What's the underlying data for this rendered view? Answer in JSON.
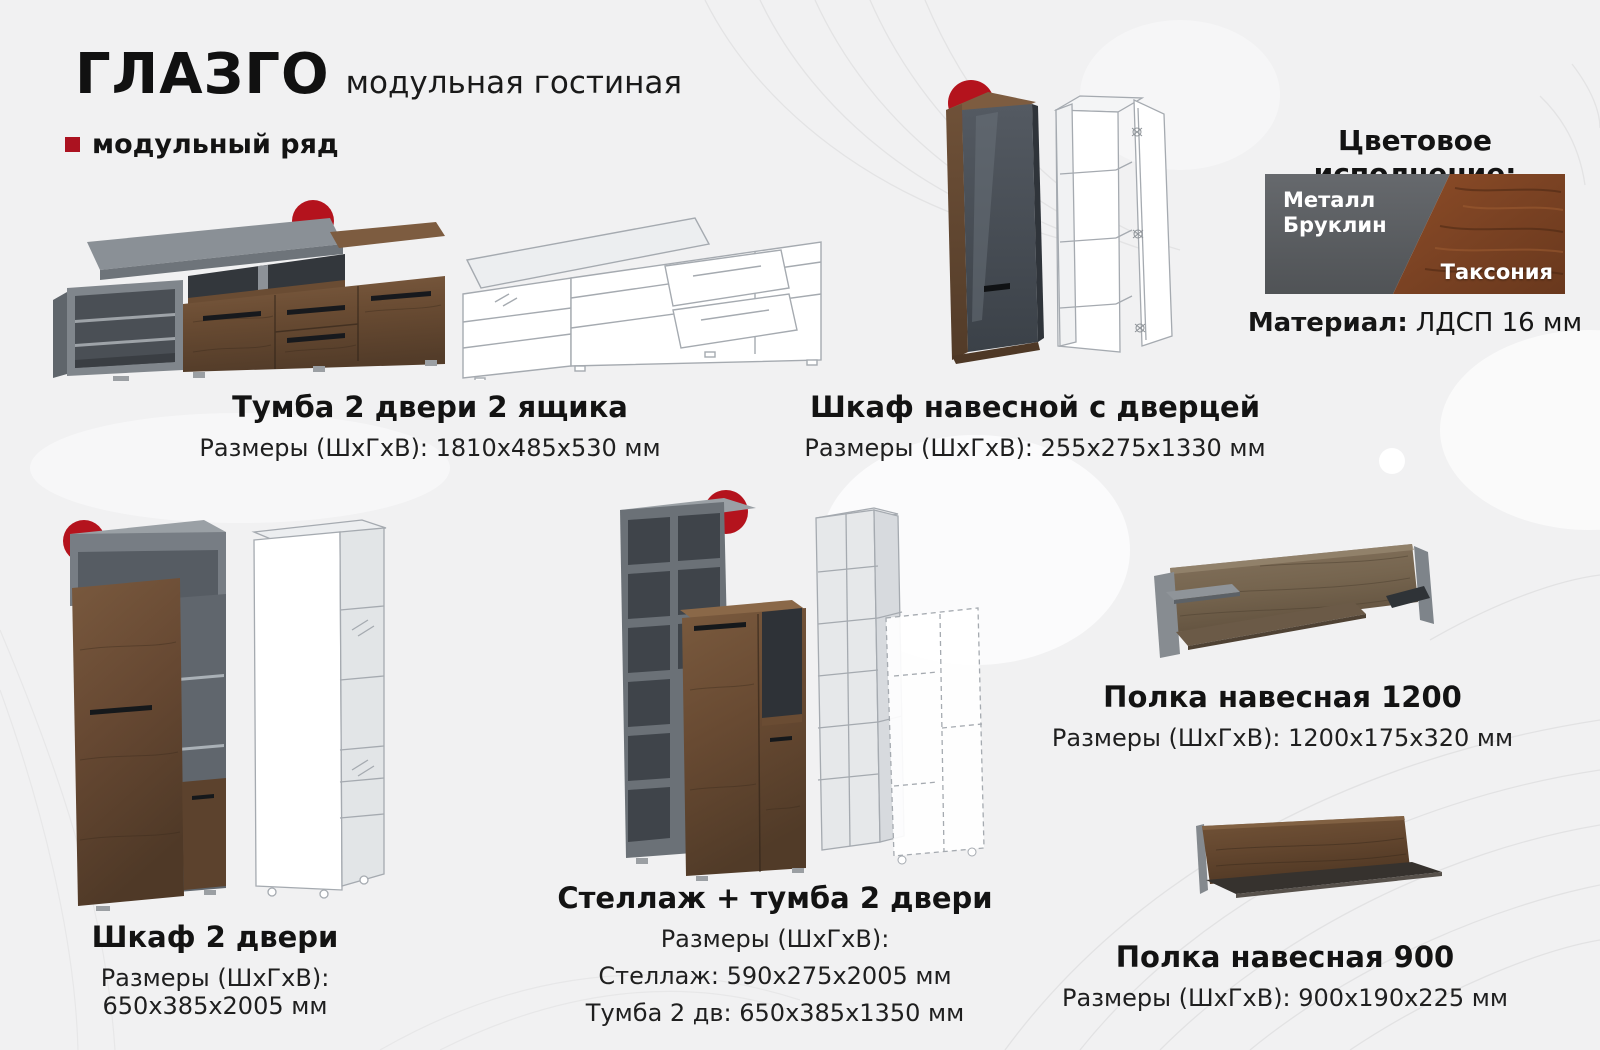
{
  "page": {
    "title": "ГЛАЗГО",
    "subtitle": "модульная гостиная",
    "series_label": "модульный ряд"
  },
  "finish": {
    "heading": "Цветовое исполнение:",
    "swatch_left": "Металл Бруклин",
    "swatch_right": "Таксония",
    "material_label": "Материал:",
    "material_value": "ЛДСП 16 мм"
  },
  "products": [
    {
      "name": "Тумба 2 двери 2 ящика",
      "dims": "Размеры (ШхГхВ): 1810х485х530 мм"
    },
    {
      "name": "Шкаф навесной с дверцей",
      "dims": "Размеры (ШхГхВ): 255х275х1330 мм"
    },
    {
      "name": "Шкаф 2 двери",
      "dims": "Размеры (ШхГхВ): 650х385х2005 мм"
    },
    {
      "name": "Стеллаж + тумба 2 двери",
      "dims_label": "Размеры (ШхГхВ):",
      "dims_lines": [
        "Стеллаж: 590х275х2005 мм",
        "Тумба 2 дв: 650х385х1350 мм"
      ]
    },
    {
      "name": "Полка навесная 1200",
      "dims": "Размеры (ШхГхВ): 1200х175х320 мм"
    },
    {
      "name": "Полка навесная 900",
      "dims": "Размеры (ШхГхВ): 900х190х225 мм"
    }
  ],
  "colors": {
    "accent_red": "#b4131d",
    "background": "#f1f1f2",
    "wood_brown": "#6a4c33",
    "metal_gray": "#6b7177"
  }
}
